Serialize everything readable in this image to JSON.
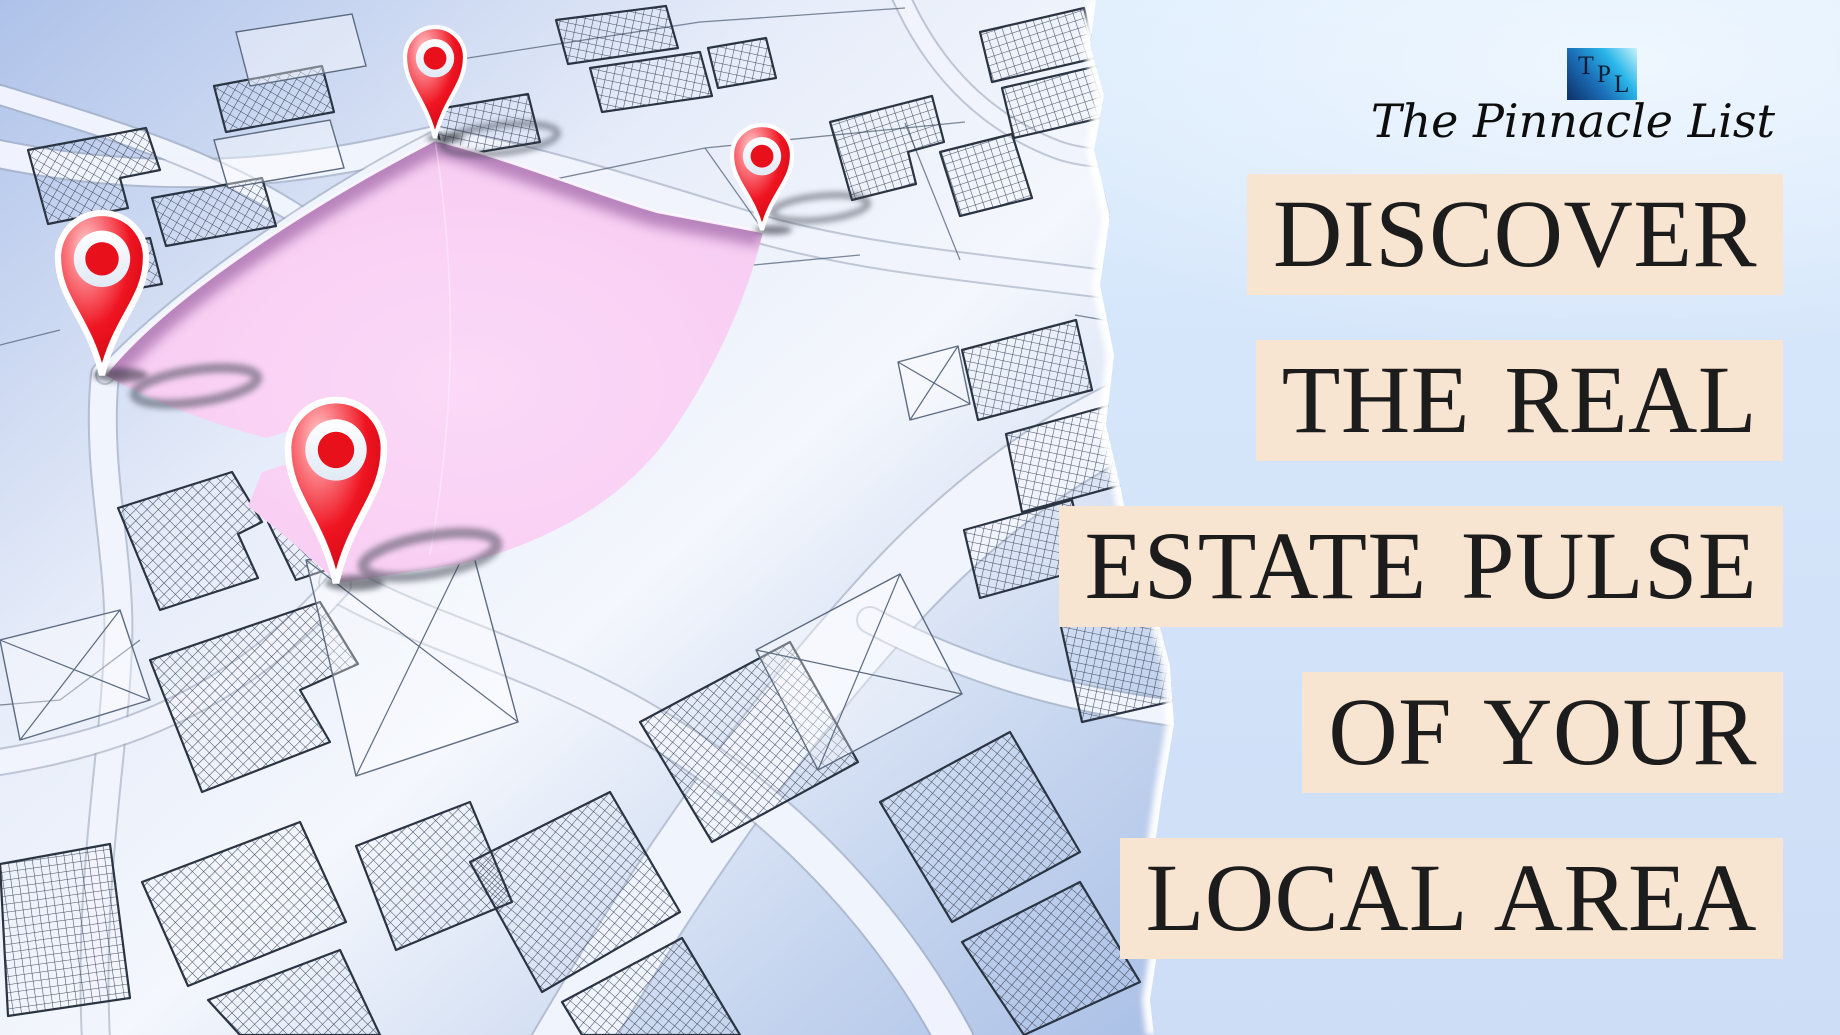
{
  "brand": {
    "monogram": {
      "t": "T",
      "p": "P",
      "l": "L"
    },
    "name": "The Pinnacle List"
  },
  "headline": {
    "lines": [
      "DISCOVER",
      "THE REAL",
      "ESTATE PULSE",
      "OF YOUR",
      "LOCAL AREA"
    ]
  },
  "map": {
    "highlighted_parcel": "selected-land-parcel",
    "pins": [
      {
        "name": "map-pin-north-icon"
      },
      {
        "name": "map-pin-west-icon"
      },
      {
        "name": "map-pin-south-icon"
      },
      {
        "name": "map-pin-east-icon"
      }
    ]
  },
  "colors": {
    "panel_blue_top": "#dcedfe",
    "panel_blue_bottom": "#cdddf6",
    "strip_cream": "#f7e4d1",
    "headline_text": "#1c1c1c",
    "script_text": "#0d0d0d",
    "monogram_text": "#0e1c35",
    "logo_dark_blue": "#0d2f66",
    "logo_cyan": "#29b6e8",
    "logo_light": "#c9f2fc",
    "pin_red": "#e8101b",
    "parcel_pink": "#f8cdf3",
    "parcel_wall": "#a871ae",
    "map_line": "#333d4d"
  }
}
